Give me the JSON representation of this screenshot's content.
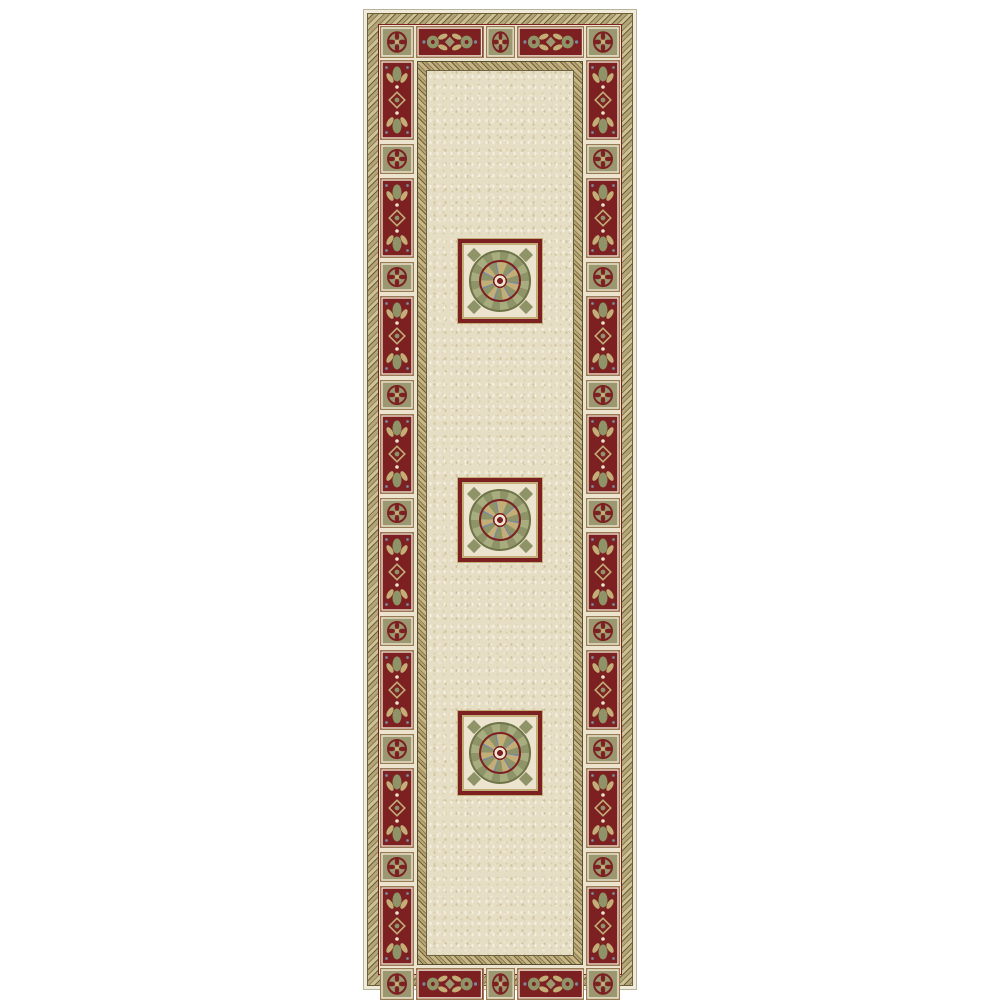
{
  "image": {
    "type": "product-photo",
    "subject": "oriental-runner-rug",
    "page_background": "#ffffff"
  },
  "rug": {
    "geometry": {
      "left": 363,
      "top": 9,
      "width": 274,
      "height": 981
    },
    "colors": {
      "cream_edge": "#f1ebdb",
      "edge_line": "#b8b49a",
      "cream_frame": "#ece4ce",
      "tile_outline": "#9a7a50",
      "maroon": "#7c2022",
      "khaki": "#9b9871",
      "sage": "#8e9468",
      "sage_light": "#a8ad7f",
      "sage_dark": "#6f7548",
      "gold": "#c2ae76",
      "slate": "#7a8aa0",
      "tan": "#b3a578",
      "rope_light": "#cdc196",
      "rope_mid": "#8a7c4e",
      "rope_dark": "#6b5f38",
      "chain_light": "#c6b787",
      "chain_dark": "#7a5a33",
      "keyline": "#57502f",
      "field_line": "#6b6242",
      "field_base": "#e6ddc5",
      "field_light": "#f4efe0",
      "field_light2": "#efe7d2",
      "field_dark": "#d9cda8",
      "field_dark2": "#cfc29b"
    },
    "border": {
      "top_row": [
        "corner-square",
        "wide-red",
        "center-square",
        "wide-red",
        "corner-square"
      ],
      "bottom_row": [
        "corner-square",
        "wide-red",
        "center-square",
        "wide-red",
        "corner-square"
      ],
      "side_red_tile_count": 8,
      "side_square_tile_count": 7
    },
    "medallions": {
      "count": 3,
      "centers_pct": [
        23.7,
        50.8,
        77.2
      ]
    }
  }
}
